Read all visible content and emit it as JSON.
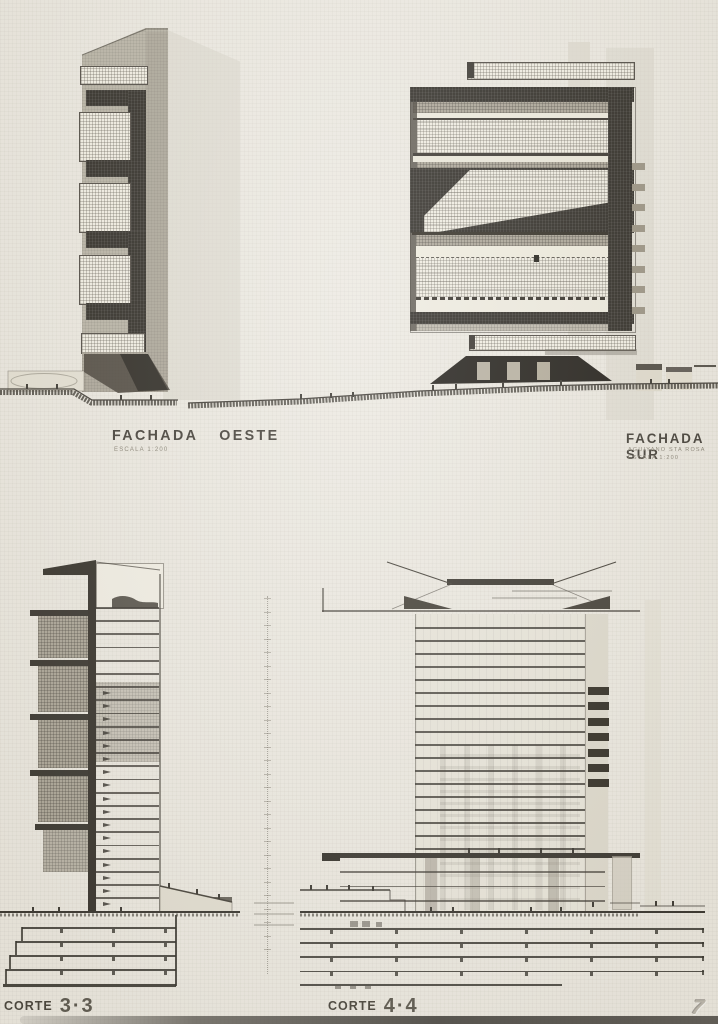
{
  "page": {
    "page_number": "7",
    "paper_color": "#ebe8e0",
    "ink_color": "#2b2823"
  },
  "labels": {
    "fachada_oeste": {
      "title": "FACHADA OESTE",
      "scale": "ESCALA 1:200"
    },
    "fachada_sur": {
      "title": "FACHADA SUR",
      "subtitle": "AGUIYANO STA ROSA",
      "scale": "ESCALA 1:200"
    },
    "corte_33": {
      "word": "CORTE",
      "number": "3·3"
    },
    "corte_44": {
      "word": "CORTE",
      "number": "4·4"
    }
  },
  "drawing_colors": {
    "tone_gray": "#b5b0a2",
    "hatch_light": "#efece1",
    "grid_gray": "#a7a193",
    "band_dark": "#221f19"
  }
}
